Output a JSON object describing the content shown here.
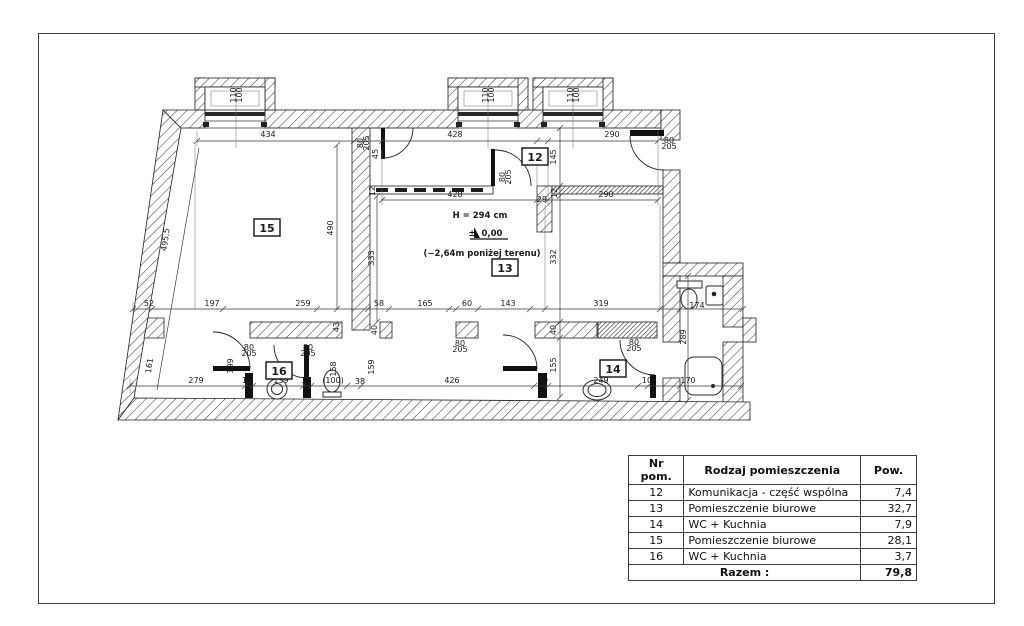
{
  "plan": {
    "window_label": {
      "lines": [
        "110",
        "100"
      ],
      "positions": [
        {
          "x": 236,
          "y": 95,
          "r": -90
        },
        {
          "x": 488,
          "y": 95,
          "r": -90
        },
        {
          "x": 573,
          "y": 95,
          "r": -90
        }
      ]
    },
    "door_label": {
      "lines": [
        "80",
        "205"
      ],
      "positions": [
        {
          "x": 363,
          "y": 143,
          "r": -90
        },
        {
          "x": 505,
          "y": 177,
          "r": -90
        },
        {
          "x": 669,
          "y": 143,
          "r": 0
        },
        {
          "x": 249,
          "y": 350,
          "r": 0
        },
        {
          "x": 308,
          "y": 350,
          "r": 0
        },
        {
          "x": 460,
          "y": 346,
          "r": 0
        },
        {
          "x": 634,
          "y": 345,
          "r": 0
        }
      ]
    },
    "rooms": [
      {
        "n": "15",
        "x": 267,
        "y": 228
      },
      {
        "n": "12",
        "x": 535,
        "y": 157
      },
      {
        "n": "13",
        "x": 505,
        "y": 268
      },
      {
        "n": "16",
        "x": 279,
        "y": 371
      },
      {
        "n": "14",
        "x": 613,
        "y": 369
      }
    ],
    "annotations": {
      "height": "H = 294 cm",
      "level_prefix": "±",
      "level": "0,00",
      "below_ground": "(−2,64m poniżej terenu)"
    },
    "dimensions": [
      {
        "t": "434",
        "x": 268,
        "y": 137
      },
      {
        "t": "428",
        "x": 455,
        "y": 137
      },
      {
        "t": "290",
        "x": 612,
        "y": 137
      },
      {
        "t": "428",
        "x": 455,
        "y": 197
      },
      {
        "t": "29",
        "x": 542,
        "y": 202,
        "fs": 7
      },
      {
        "t": "290",
        "x": 606,
        "y": 197
      },
      {
        "t": "12",
        "x": 375,
        "y": 191,
        "r": -90,
        "fs": 6.5
      },
      {
        "t": "12",
        "x": 557,
        "y": 193,
        "r": -90,
        "fs": 6.5
      },
      {
        "t": "145",
        "x": 556,
        "y": 157,
        "r": -90
      },
      {
        "t": "45",
        "x": 378,
        "y": 154,
        "r": -90,
        "fs": 6.5
      },
      {
        "t": "490",
        "x": 333,
        "y": 228,
        "r": -90
      },
      {
        "t": "333",
        "x": 374,
        "y": 258,
        "r": -90
      },
      {
        "t": "332",
        "x": 556,
        "y": 257,
        "r": -90
      },
      {
        "t": "495,5",
        "x": 168,
        "y": 240,
        "r": -82
      },
      {
        "t": "52",
        "x": 149,
        "y": 306
      },
      {
        "t": "197",
        "x": 212,
        "y": 306
      },
      {
        "t": "259",
        "x": 303,
        "y": 306
      },
      {
        "t": "58",
        "x": 379,
        "y": 306
      },
      {
        "t": "165",
        "x": 425,
        "y": 306
      },
      {
        "t": "60",
        "x": 467,
        "y": 306
      },
      {
        "t": "143",
        "x": 508,
        "y": 306
      },
      {
        "t": "319",
        "x": 601,
        "y": 306
      },
      {
        "t": "174",
        "x": 697,
        "y": 308
      },
      {
        "t": "279",
        "x": 196,
        "y": 383
      },
      {
        "t": "10",
        "x": 247,
        "y": 383,
        "fs": 6.5
      },
      {
        "t": "139",
        "x": 281,
        "y": 383
      },
      {
        "t": "10",
        "x": 306,
        "y": 383,
        "fs": 6.5
      },
      {
        "t": "(100)",
        "x": 333,
        "y": 383,
        "fs": 7
      },
      {
        "t": "38",
        "x": 360,
        "y": 384,
        "fs": 6.5
      },
      {
        "t": "426",
        "x": 452,
        "y": 383
      },
      {
        "t": "39",
        "x": 543,
        "y": 383,
        "fs": 6.5
      },
      {
        "t": "249",
        "x": 601,
        "y": 383
      },
      {
        "t": "10",
        "x": 647,
        "y": 383,
        "fs": 6.5
      },
      {
        "t": "170",
        "x": 688,
        "y": 383
      },
      {
        "t": "161",
        "x": 152,
        "y": 366,
        "r": -82
      },
      {
        "t": "199",
        "x": 233,
        "y": 366,
        "r": -90
      },
      {
        "t": "158",
        "x": 336,
        "y": 369,
        "r": -90
      },
      {
        "t": "159",
        "x": 374,
        "y": 367,
        "r": -90
      },
      {
        "t": "43",
        "x": 339,
        "y": 327,
        "r": -90,
        "fs": 6.5
      },
      {
        "t": "40",
        "x": 377,
        "y": 330,
        "r": -90,
        "fs": 6.5
      },
      {
        "t": "40",
        "x": 556,
        "y": 330,
        "r": -90,
        "fs": 6.5
      },
      {
        "t": "155",
        "x": 556,
        "y": 365,
        "r": -90
      },
      {
        "t": "289",
        "x": 686,
        "y": 337,
        "r": -90
      }
    ]
  },
  "table": {
    "headers": [
      "Nr pom.",
      "Rodzaj pomieszczenia",
      "Pow."
    ],
    "rows": [
      [
        "12",
        "Komunikacja - część wspólna",
        "7,4"
      ],
      [
        "13",
        "Pomieszczenie biurowe",
        "32,7"
      ],
      [
        "14",
        "WC + Kuchnia",
        "7,9"
      ],
      [
        "15",
        "Pomieszczenie biurowe",
        "28,1"
      ],
      [
        "16",
        "WC + Kuchnia",
        "3,7"
      ]
    ],
    "total_label": "Razem :",
    "total_value": "79,8"
  }
}
